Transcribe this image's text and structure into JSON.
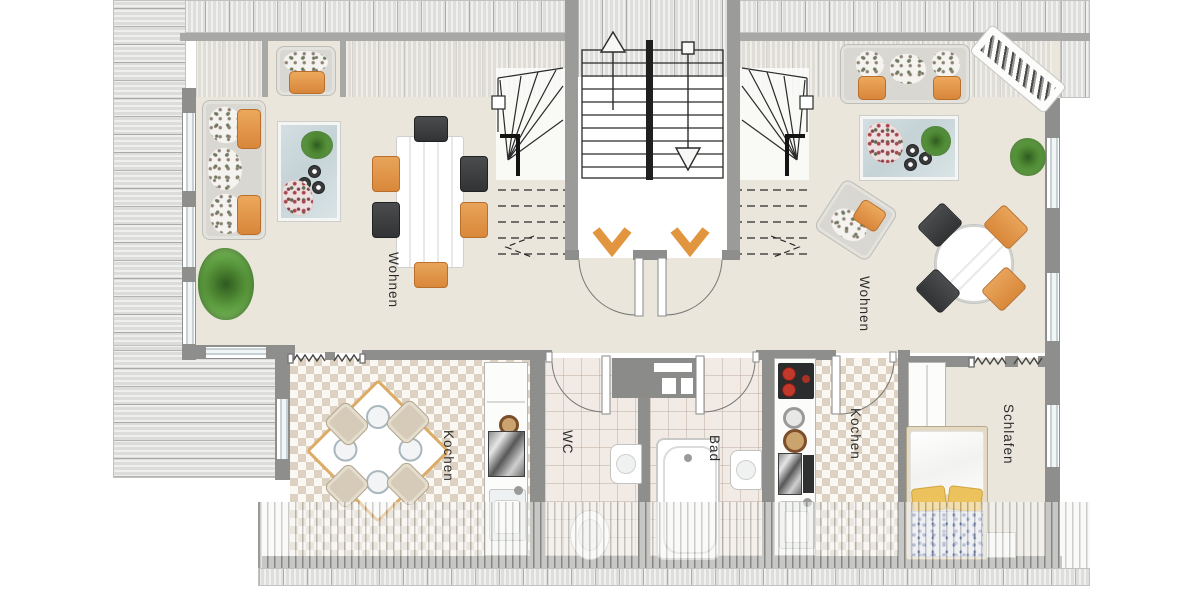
{
  "floorplan": {
    "type": "attic floor plan, two mirrored apartments around central stairwell",
    "rooms": [
      {
        "id": "living-left",
        "label": "Wohnen"
      },
      {
        "id": "kitchen-left",
        "label": "Kochen"
      },
      {
        "id": "wc",
        "label": "WC"
      },
      {
        "id": "bath",
        "label": "Bad"
      },
      {
        "id": "kitchen-right",
        "label": "Kochen"
      },
      {
        "id": "bedroom",
        "label": "Schlafen"
      },
      {
        "id": "living-right",
        "label": "Wohnen"
      }
    ],
    "colors": {
      "floor_beige": "#eae6dc",
      "wall_gray": "#8e8e8c",
      "accent_orange": "#e2953f",
      "roof_stripe": "#dcdcda",
      "tile_diamond": "#ddd2c2",
      "tile_bath": "#f2ebe5",
      "chair_dark": "#3e4042",
      "glass_table": "#ccd9dd",
      "pillow_yellow": "#ecc25c"
    },
    "symbols": [
      "stair-up-arrow",
      "stair-down-arrow",
      "entry-chevrons-orange",
      "door-swing-arcs",
      "wall-break-zigzags"
    ]
  }
}
